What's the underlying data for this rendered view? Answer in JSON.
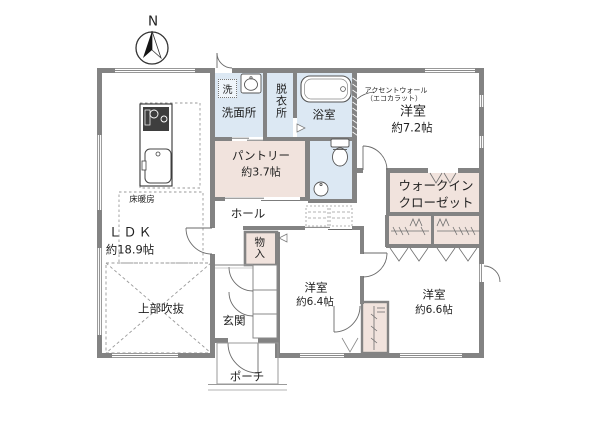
{
  "compass": {
    "north_label": "N"
  },
  "colors": {
    "wall": "#838383",
    "wet_area": "#dce8f3",
    "storage_area": "#f1e3dd"
  },
  "rooms": {
    "ldk": {
      "name": "ＬＤＫ",
      "size": "約18.9帖"
    },
    "void_above": {
      "name": "上部吹抜"
    },
    "floor_heating": {
      "name": "床暖房"
    },
    "laundry": {
      "name": "洗面所",
      "washer": "洗"
    },
    "dressing": {
      "name": "脱衣所"
    },
    "bath": {
      "name": "浴室"
    },
    "pantry": {
      "name": "パントリー",
      "size": "約3.7帖"
    },
    "hall": {
      "name": "ホール"
    },
    "bedroom1": {
      "name": "洋室",
      "size": "約7.2帖",
      "note_line1": "アクセントウォール",
      "note_line2": "（エコカラット）"
    },
    "wic": {
      "name_line1": "ウォークイン",
      "name_line2": "クローゼット"
    },
    "storage": {
      "name": "物入"
    },
    "entrance": {
      "name": "玄関"
    },
    "porch": {
      "name": "ポーチ"
    },
    "bedroom2": {
      "name": "洋室",
      "size": "約6.4帖"
    },
    "bedroom3": {
      "name": "洋室",
      "size": "約6.6帖"
    }
  }
}
